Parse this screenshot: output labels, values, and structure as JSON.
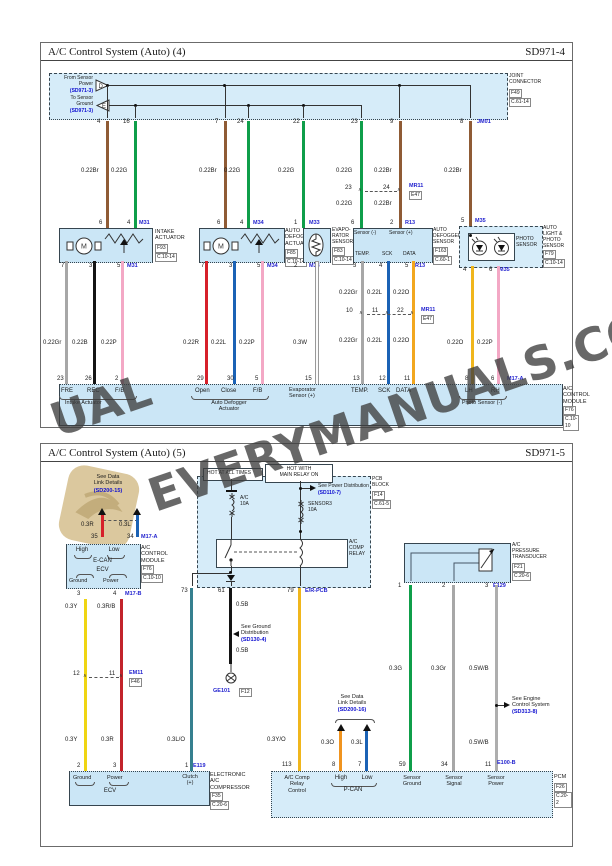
{
  "watermark": {
    "text": "EVERYMANUALS.COM",
    "fragment": "UAL"
  },
  "colors": {
    "box_fill": "#cbe6f6",
    "dash_fill": "#d6ecf9",
    "brown": "#8f5b35",
    "green": "#0f9e4a",
    "gray": "#a7a7a7",
    "black": "#141414",
    "pink": "#f3a8c5",
    "red": "#d6202a",
    "blue": "#1b62b5",
    "orange": "#f2a71f",
    "amber": "#f0b61c",
    "yellow": "#efd513",
    "white_wire": "#fbfbfb",
    "teal": "#35808f",
    "orange3": "#f0941f",
    "connector_blue": "#2323cf",
    "ref_blue": "#0f0fd0"
  },
  "d4": {
    "title": "A/C Control System (Auto) (4)",
    "code": "SD971-4",
    "bus": {
      "from_label": "From Sensor\nPower",
      "from_ref": "(SD971-3)",
      "from_letter": "D",
      "to_label": "To Sensor\nGround",
      "to_ref": "(SD971-3)",
      "to_letter": "E",
      "joint": "JOINT\nCONNECTOR",
      "joint_ref": "F49",
      "joint_loc": "C.61-14",
      "conn": "JM01",
      "pins": [
        "4",
        "16",
        "7",
        "24",
        "22",
        "23",
        "9",
        "8"
      ]
    },
    "wires": {
      "top": [
        "0.22Br",
        "0.22G",
        "0.22Br",
        "0.22G",
        "0.22G",
        "0.22G",
        "0.22Br",
        "0.22Br"
      ],
      "mid": [
        "0.22G",
        "0.22Br"
      ],
      "sen_top": [
        "0.22Gr",
        "0.22L",
        "0.22O"
      ],
      "sen_bot": [
        "0.22Gr",
        "0.22L",
        "0.22O"
      ],
      "low": [
        "0.22Gr",
        "0.22B",
        "0.22P",
        "0.22R",
        "0.22L",
        "0.22P",
        "0.3W",
        "0.22O",
        "0.22P"
      ]
    },
    "j1": {
      "pins": [
        "23",
        "24"
      ],
      "name": "MR11",
      "ref": "E47"
    },
    "j2": {
      "pins": [
        "10",
        "11",
        "22"
      ],
      "name": "MR11",
      "ref": "E47"
    },
    "intake": {
      "name": "INTAKE\nACTUATOR",
      "ref": "F93",
      "loc": "C.10-14",
      "conn": "M31",
      "top_pins": [
        "6",
        "4"
      ],
      "bot_pins": [
        "7",
        "3",
        "5"
      ]
    },
    "defog_act": {
      "name": "AUTO\nDEFOGGER\nACTUATOR",
      "ref": "F85",
      "loc": "C.10-14",
      "conn": "M34",
      "top_pins": [
        "6",
        "4"
      ],
      "bot_pins": [
        "7",
        "3",
        "5"
      ]
    },
    "evap": {
      "name": "EVAPO-\nRATOR\nSENSOR",
      "ref": "F83",
      "loc": "C.10-14",
      "conn": "M33",
      "top_pin": "1",
      "bot_pin": "2"
    },
    "defog_sen": {
      "name": "AUTO\nDEFOGGER\nSENSOR",
      "ref": "F163",
      "loc": "C.60-1",
      "conn": "R13",
      "top_pins": [
        "6",
        "2"
      ],
      "in_top": [
        "Sensor (-)",
        "Sensor (+)"
      ],
      "in_bot": [
        "TEMP.",
        "SCK",
        "DATA"
      ],
      "bot_pins": [
        "3",
        "4",
        "5"
      ]
    },
    "photo": {
      "inner": "PHOTO\nSENSOR",
      "name": "AUTO\nLIGHT &\nPHOTO\nSENSOR",
      "ref": "F79",
      "loc": "C.10-14",
      "conn": "M35",
      "top_pin": "5",
      "bot_pins": [
        "4",
        "6"
      ]
    },
    "module": {
      "pins": [
        "23",
        "26",
        "2",
        "29",
        "30",
        "5",
        "15",
        "13",
        "12",
        "11",
        "8",
        "6"
      ],
      "labels": [
        "FRE",
        "REC",
        "F/B",
        "Open",
        "Close",
        "F/B",
        "TEMP.",
        "SCK",
        "DATA",
        "LH",
        "RH"
      ],
      "evap_label": "Evaporator\nSensor (+)",
      "groups": [
        "Intake Actuator",
        "Auto Defogger\nActuator",
        "Photo Sensor (-)"
      ],
      "conn": "M17-A",
      "name": "A/C\nCONTROL\nMODULE",
      "ref": "F76",
      "loc": "C.10-10"
    }
  },
  "d5": {
    "title": "A/C Control System (Auto) (5)",
    "code": "SD971-5",
    "datalink1": {
      "note": "See Data\nLink Details",
      "ref": "(SD200-15)"
    },
    "can": {
      "labels": [
        "0.3R",
        "0.3L"
      ],
      "pins": [
        "35",
        "34"
      ],
      "conn": "M17-A"
    },
    "module": {
      "high": "High",
      "low": "Low",
      "ecan": "E-CAN",
      "ecv": "ECV",
      "ground": "Ground",
      "power": "Power",
      "name": "A/C\nCONTROL\nMODULE",
      "ref": "F76",
      "loc": "C.10-10",
      "bot_pins": [
        "3",
        "4"
      ],
      "conn_b": "M17-B"
    },
    "left_wires": {
      "y1": "0.3Y",
      "rb": "0.3R/B",
      "y2": "0.3Y",
      "r2": "0.3R",
      "lo": "0.3L/O"
    },
    "j3": {
      "pins": [
        "12",
        "11"
      ],
      "name": "EM11",
      "ref": "F46"
    },
    "ecv": {
      "ground": "Ground",
      "power": "Power",
      "name": "ECV",
      "clutch": "Clutch\n(+)",
      "pins": [
        "2",
        "3",
        "1"
      ],
      "conn": "E119",
      "comp_name": "ELECTRONIC\nA/C\nCOMPRESSOR",
      "ref": "F35",
      "loc": "C.20-6"
    },
    "relay": {
      "hot1": "HOT AT ALL TIMES",
      "hot2": "HOT WITH\nMAIN RELAY ON",
      "fuse1": "A/C\n10A",
      "fuse2": "SENSOR3\n10A",
      "name": "A/C\nCOMP\nRELAY",
      "power_note": "See Power Distribution",
      "power_ref": "(SD110-7)",
      "block": "PCB\nBLOCK",
      "block_ref": "F14",
      "block_loc": "C.61-5",
      "pins": [
        "73",
        "61",
        "79"
      ],
      "conn": "E/R-PCB"
    },
    "ground": {
      "w1": "0.5B",
      "w2": "0.5B",
      "note": "See Ground\nDistribution",
      "ref": "(SD130-4)",
      "name": "GE101",
      "loc": "F12"
    },
    "comp_ctl": {
      "wire": "0.3Y/O",
      "pin": "113",
      "label": "A/C Comp\nRelay\nControl"
    },
    "pcan": {
      "note": "See Data\nLink Details",
      "ref": "(SD200-16)",
      "labels": [
        "0.3O",
        "0.3L"
      ],
      "pins": [
        "8",
        "7"
      ],
      "high": "High",
      "low": "Low",
      "name": "P-CAN"
    },
    "trans": {
      "name": "A/C\nPRESSURE\nTRANSDUCER",
      "ref": "F21",
      "loc": "C.20-6",
      "pins": [
        "1",
        "2",
        "3"
      ],
      "conn": "E129",
      "w": [
        "0.3G",
        "0.3Gr",
        "0.5W/B"
      ],
      "w2": "0.5W/B"
    },
    "engine_note": {
      "note": "See Engine\nControl System",
      "ref": "(SD313-8)"
    },
    "pcm": {
      "pins": [
        "59",
        "34",
        "11"
      ],
      "labels": [
        "Sensor\nGround",
        "Sensor\nSignal",
        "Sensor\nPower"
      ],
      "conn": "E100-B",
      "name": "PCM",
      "ref": "F26",
      "loc": "C.20-2"
    }
  }
}
